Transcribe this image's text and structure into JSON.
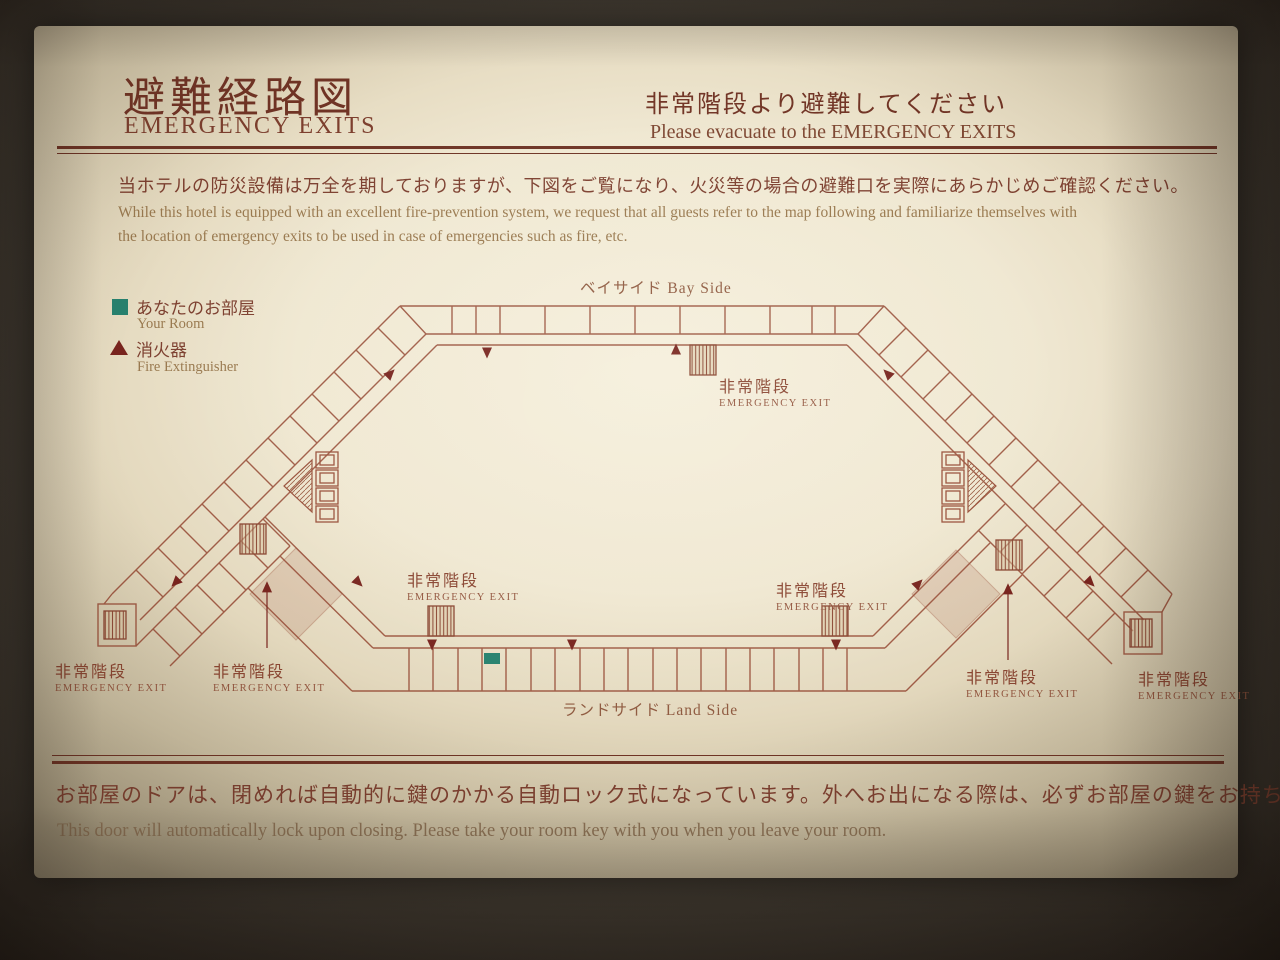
{
  "sign": {
    "header": {
      "title_jp": "避難経路図",
      "title_en": "EMERGENCY EXITS",
      "notice_jp": "非常階段より避難してください",
      "notice_en": "Please evacuate to the EMERGENCY EXITS"
    },
    "intro": {
      "jp": "当ホテルの防災設備は万全を期しておりますが、下図をご覧になり、火災等の場合の避難口を実際にあらかじめご確認ください。",
      "en_line1": "While this hotel is equipped with an excellent fire-prevention system, we request that all guests refer to the map following and familiarize themselves with",
      "en_line2": "the location of emergency exits to be used in case of emergencies  such as fire, etc."
    },
    "legend": {
      "your_room": {
        "jp": "あなたのお部屋",
        "en": "Your Room",
        "icon": "teal-square",
        "color": "#27816e"
      },
      "fire_extinguisher": {
        "jp": "消火器",
        "en": "Fire Extinguisher",
        "icon": "maroon-triangle",
        "color": "#78241e"
      }
    },
    "map": {
      "bay_side": "ベイサイド  Bay Side",
      "land_side": "ランドサイド  Land Side",
      "exits": [
        {
          "id": "bay-center",
          "jp": "非常階段",
          "en": "EMERGENCY EXIT"
        },
        {
          "id": "land-left",
          "jp": "非常階段",
          "en": "EMERGENCY EXIT"
        },
        {
          "id": "land-right",
          "jp": "非常階段",
          "en": "EMERGENCY EXIT"
        },
        {
          "id": "west-wing-tip",
          "jp": "非常階段",
          "en": "EMERGENCY EXIT"
        },
        {
          "id": "west-wing-junction",
          "jp": "非常階段",
          "en": "EMERGENCY EXIT"
        },
        {
          "id": "east-wing-junction",
          "jp": "非常階段",
          "en": "EMERGENCY EXIT"
        },
        {
          "id": "east-wing-tip",
          "jp": "非常階段",
          "en": "EMERGENCY EXIT"
        }
      ]
    },
    "footer": {
      "jp": "お部屋のドアは、閉めれば自動的に鍵のかかる自動ロック式になっています。外へお出になる際は、必ずお部屋の鍵をお持ちください。",
      "en": "This door will automatically lock upon closing. Please take your room key with you when you leave your room."
    },
    "colors": {
      "line_maroon": "#9a523c",
      "text_maroon": "#713425",
      "text_gold": "#99794f",
      "room_teal": "#27816e",
      "arrow_red": "#78241e",
      "sign_background": "#efe8d3"
    }
  }
}
